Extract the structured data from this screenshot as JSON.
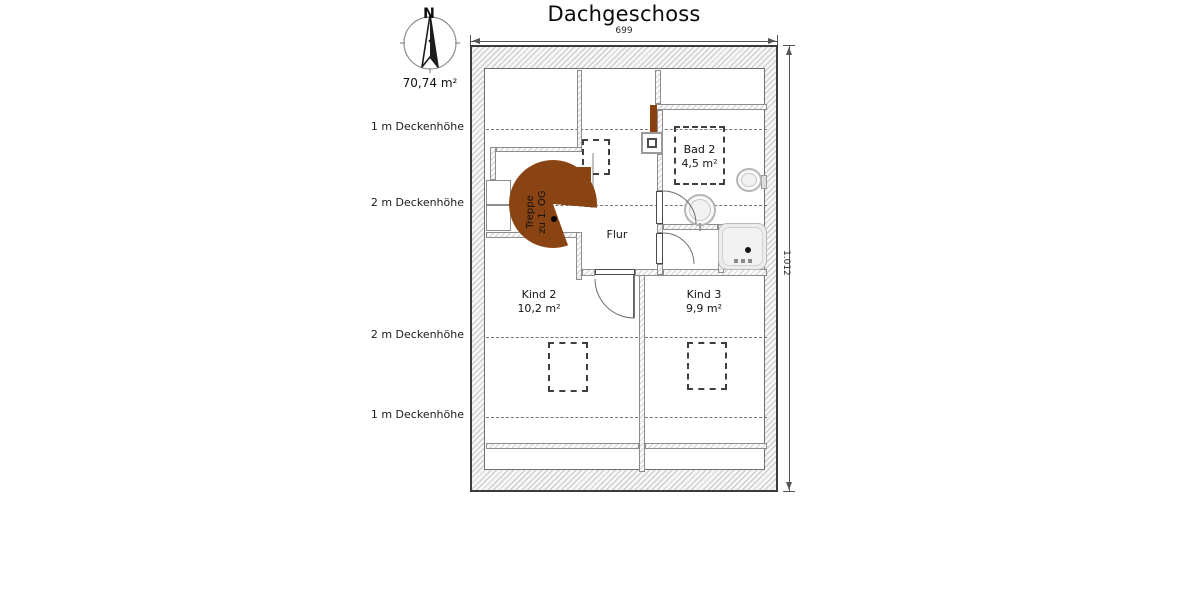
{
  "title": "Dachgeschoss",
  "compass": {
    "north": "N",
    "area": "70,74 m²"
  },
  "dimensions": {
    "top": "699",
    "right": "1.012"
  },
  "ceiling_height_labels": [
    "1 m Deckenhöhe",
    "2 m Deckenhöhe",
    "2 m Deckenhöhe",
    "1 m Deckenhöhe"
  ],
  "rooms": {
    "treppe": {
      "label_line1": "Treppe",
      "label_line2": "zu 1. OG"
    },
    "flur": {
      "name": "Flur"
    },
    "bad2": {
      "name": "Bad 2",
      "area": "4,5 m²"
    },
    "kind2": {
      "name": "Kind 2",
      "area": "10,2 m²"
    },
    "kind3": {
      "name": "Kind 3",
      "area": "9,9 m²"
    }
  },
  "colors": {
    "stair_brown": "#8a4413",
    "chimney_brown": "#8a4010",
    "wall_hatch": "#c6c6c6",
    "outline": "#3c3c3c"
  }
}
